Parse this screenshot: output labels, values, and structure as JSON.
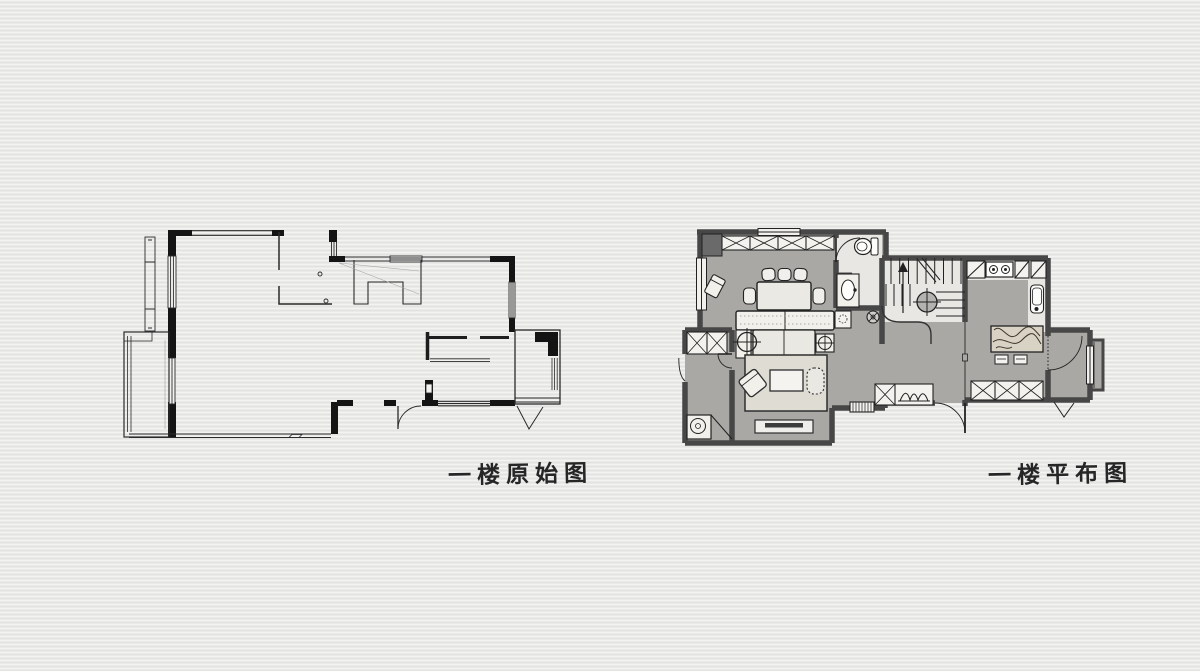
{
  "page": {
    "background_color": "#eaeae8",
    "description_labels": 2
  },
  "captions": {
    "original": "一楼原始图",
    "layout": "一楼平布图"
  },
  "plans": {
    "original": {
      "title": "一楼原始图",
      "style": "black-line architectural base plan",
      "wall_color": "#141414",
      "line_color": "#2b2b2b",
      "features": [
        "exterior-walls",
        "windows",
        "door-swings",
        "balcony",
        "bay-window",
        "interior-partitions",
        "stair-opening-outline"
      ]
    },
    "layout": {
      "title": "一楼平布图",
      "style": "hand-drawn furnished layout plan",
      "wall_color": "#474747",
      "floor_color": "#a9a8a5",
      "furniture_color": "#f1f0eb",
      "rug_color": "#dedcd3",
      "wood_color": "#d9d3c6",
      "features": [
        "dining-table",
        "dining-chairs",
        "storage-cabinets",
        "window-seat",
        "sofa",
        "end-table",
        "ceiling-lamps",
        "floor-drain",
        "rug",
        "coffee-table",
        "armchair",
        "pouf",
        "tv-cabinet",
        "entry-bench",
        "plant-cabinet",
        "entry-door",
        "stairs",
        "stair-arrow",
        "bathroom-toilet",
        "bathroom-vanity",
        "kitchen-stove",
        "kitchen-sink",
        "wood-breakfast-table",
        "stools",
        "balcony-washer",
        "balcony-cabinet",
        "side-room-door",
        "bay-platform"
      ]
    }
  }
}
